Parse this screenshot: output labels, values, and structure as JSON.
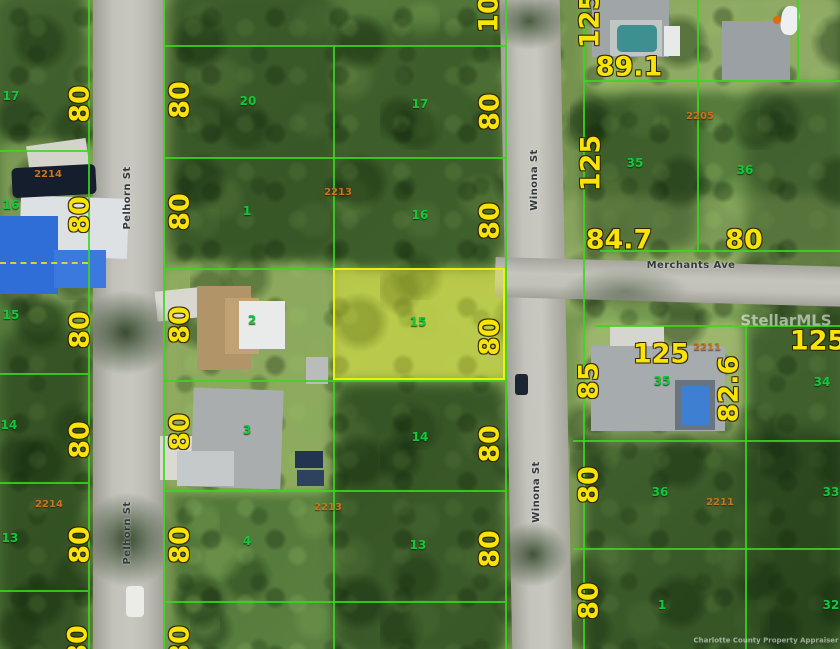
{
  "map": {
    "width": 840,
    "height": 649,
    "colors": {
      "lot_line": "#3bd71d",
      "dimension_text": "#f8e408",
      "lot_number_text": "#12c93c",
      "parcel_number_text": "#c8731f",
      "street_text": "#33383b",
      "highlight_fill": "rgba(235,235,45,0.38)",
      "highlight_border": "#eff00c"
    },
    "streets": [
      {
        "name": "Pelhorn St",
        "orientation": "vertical",
        "labels": [
          {
            "x": 128,
            "y": 198,
            "rot": true
          },
          {
            "x": 128,
            "y": 533,
            "rot": true
          }
        ]
      },
      {
        "name": "Winona St",
        "orientation": "vertical",
        "labels": [
          {
            "x": 535,
            "y": 180,
            "rot": true
          },
          {
            "x": 537,
            "y": 492,
            "rot": true
          }
        ]
      },
      {
        "name": "Merchants Ave",
        "orientation": "horizontal",
        "labels": [
          {
            "x": 691,
            "y": 266,
            "rot": false
          }
        ]
      }
    ],
    "dimension_labels": [
      {
        "text": "80",
        "x": 80,
        "y": 104,
        "rot": true
      },
      {
        "text": "80",
        "x": 80,
        "y": 215,
        "rot": true
      },
      {
        "text": "80",
        "x": 80,
        "y": 330,
        "rot": true
      },
      {
        "text": "80",
        "x": 80,
        "y": 440,
        "rot": true
      },
      {
        "text": "80",
        "x": 80,
        "y": 545,
        "rot": true
      },
      {
        "text": "80",
        "x": 78,
        "y": 644,
        "rot": true
      },
      {
        "text": "80",
        "x": 180,
        "y": 100,
        "rot": true
      },
      {
        "text": "80",
        "x": 180,
        "y": 212,
        "rot": true
      },
      {
        "text": "80",
        "x": 180,
        "y": 325,
        "rot": true
      },
      {
        "text": "80",
        "x": 180,
        "y": 432,
        "rot": true
      },
      {
        "text": "80",
        "x": 180,
        "y": 545,
        "rot": true
      },
      {
        "text": "80",
        "x": 180,
        "y": 644,
        "rot": true
      },
      {
        "text": "10",
        "x": 489,
        "y": 14,
        "rot": true
      },
      {
        "text": "80",
        "x": 490,
        "y": 112,
        "rot": true
      },
      {
        "text": "80",
        "x": 490,
        "y": 221,
        "rot": true
      },
      {
        "text": "80",
        "x": 490,
        "y": 337,
        "rot": true
      },
      {
        "text": "80",
        "x": 490,
        "y": 444,
        "rot": true
      },
      {
        "text": "80",
        "x": 490,
        "y": 549,
        "rot": true
      },
      {
        "text": "125",
        "x": 590,
        "y": 20,
        "rot": true
      },
      {
        "text": "125",
        "x": 591,
        "y": 163,
        "rot": true
      },
      {
        "text": "85",
        "x": 589,
        "y": 381,
        "rot": true
      },
      {
        "text": "82.6",
        "x": 729,
        "y": 389,
        "rot": true
      },
      {
        "text": "80",
        "x": 589,
        "y": 485,
        "rot": true
      },
      {
        "text": "80",
        "x": 589,
        "y": 601,
        "rot": true
      },
      {
        "text": "89.1",
        "x": 629,
        "y": 67,
        "rot": false
      },
      {
        "text": "84.7",
        "x": 619,
        "y": 240,
        "rot": false
      },
      {
        "text": "80",
        "x": 744,
        "y": 240,
        "rot": false
      },
      {
        "text": "125",
        "x": 661,
        "y": 354,
        "rot": false
      },
      {
        "text": "125",
        "x": 818,
        "y": 341,
        "rot": false
      }
    ],
    "lot_numbers": [
      {
        "text": "17",
        "x": 11,
        "y": 96
      },
      {
        "text": "20",
        "x": 248,
        "y": 101
      },
      {
        "text": "17",
        "x": 420,
        "y": 104
      },
      {
        "text": "16",
        "x": 11,
        "y": 205
      },
      {
        "text": "1",
        "x": 247,
        "y": 211
      },
      {
        "text": "16",
        "x": 420,
        "y": 215
      },
      {
        "text": "15",
        "x": 11,
        "y": 315
      },
      {
        "text": "2",
        "x": 252,
        "y": 320
      },
      {
        "text": "15",
        "x": 418,
        "y": 322
      },
      {
        "text": "14",
        "x": 9,
        "y": 425
      },
      {
        "text": "3",
        "x": 247,
        "y": 430
      },
      {
        "text": "14",
        "x": 420,
        "y": 437
      },
      {
        "text": "13",
        "x": 10,
        "y": 538
      },
      {
        "text": "4",
        "x": 247,
        "y": 541
      },
      {
        "text": "13",
        "x": 418,
        "y": 545
      },
      {
        "text": "35",
        "x": 635,
        "y": 163
      },
      {
        "text": "36",
        "x": 745,
        "y": 170
      },
      {
        "text": "35",
        "x": 662,
        "y": 381
      },
      {
        "text": "34",
        "x": 822,
        "y": 382
      },
      {
        "text": "36",
        "x": 660,
        "y": 492
      },
      {
        "text": "33",
        "x": 831,
        "y": 492
      },
      {
        "text": "1",
        "x": 662,
        "y": 605
      },
      {
        "text": "32",
        "x": 831,
        "y": 605
      }
    ],
    "parcel_numbers": [
      {
        "text": "2214",
        "x": 48,
        "y": 175
      },
      {
        "text": "2213",
        "x": 338,
        "y": 193
      },
      {
        "text": "2205",
        "x": 700,
        "y": 117
      },
      {
        "text": "2211",
        "x": 707,
        "y": 348
      },
      {
        "text": "2214",
        "x": 49,
        "y": 505
      },
      {
        "text": "2213",
        "x": 328,
        "y": 508
      },
      {
        "text": "2211",
        "x": 720,
        "y": 503
      }
    ],
    "highlighted_lot": {
      "number": "15",
      "x": 333,
      "y": 268,
      "width": 172,
      "height": 112
    },
    "lot_lines": {
      "vertical": [
        {
          "x": 88,
          "y": 0,
          "h": 649
        },
        {
          "x": 163,
          "y": 0,
          "h": 649
        },
        {
          "x": 333,
          "y": 45,
          "h": 604
        },
        {
          "x": 505,
          "y": 0,
          "h": 649
        },
        {
          "x": 583,
          "y": 0,
          "h": 649
        },
        {
          "x": 697,
          "y": 0,
          "h": 252
        },
        {
          "x": 745,
          "y": 325,
          "h": 324
        },
        {
          "x": 797,
          "y": 0,
          "h": 82
        }
      ],
      "horizontal": [
        {
          "x": 0,
          "y": 150,
          "w": 88
        },
        {
          "x": 0,
          "y": 373,
          "w": 88
        },
        {
          "x": 0,
          "y": 482,
          "w": 88
        },
        {
          "x": 0,
          "y": 590,
          "w": 88
        },
        {
          "x": 163,
          "y": 45,
          "w": 342
        },
        {
          "x": 163,
          "y": 157,
          "w": 342
        },
        {
          "x": 163,
          "y": 268,
          "w": 342
        },
        {
          "x": 163,
          "y": 380,
          "w": 342
        },
        {
          "x": 163,
          "y": 490,
          "w": 342
        },
        {
          "x": 163,
          "y": 601,
          "w": 342
        },
        {
          "x": 583,
          "y": 80,
          "w": 257
        },
        {
          "x": 600,
          "y": 250,
          "w": 240
        },
        {
          "x": 595,
          "y": 325,
          "w": 245
        },
        {
          "x": 573,
          "y": 440,
          "w": 267
        },
        {
          "x": 573,
          "y": 548,
          "w": 267
        }
      ],
      "dashed": [
        {
          "x": 0,
          "y": 262,
          "w": 88
        }
      ]
    },
    "watermarks": [
      {
        "text": "StellarMLS",
        "x": 786,
        "y": 321,
        "size": 15
      },
      {
        "text": "Charlotte County Property Appraiser",
        "x": 766,
        "y": 641,
        "size": 7
      }
    ]
  }
}
